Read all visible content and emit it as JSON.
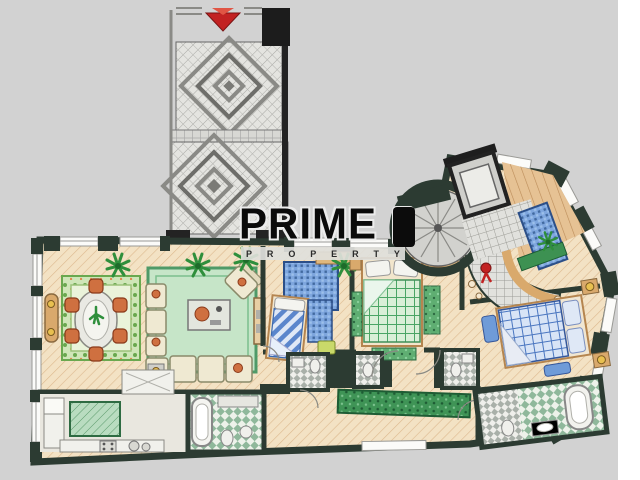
{
  "watermark": {
    "title": "PRIME",
    "subtitle": "PROPERTY",
    "subtitle_letters": [
      "P",
      "R",
      "O",
      "P",
      "E",
      "R",
      "T",
      "Y"
    ]
  },
  "palette": {
    "background": "#d2d2d2",
    "paper_margin": "#ffffff",
    "wall_dark": "#2c3b32",
    "vestibule_wall": "#232323",
    "floor_wood": "#f3e2c4",
    "tile_gray": "#e1e1dd",
    "rug_green": "#c6e5c8",
    "rug_blue": "#6f9bd8",
    "bed_green_plaid": "#4aa565",
    "bed_blue_plaid": "#4a76c0",
    "wood_trim": "#d9a96c",
    "chair_terracotta": "#cf7040",
    "plant_green": "#2f8f3c",
    "entry_marker_red": "#c22222",
    "watermark_ink": "#0a0a0a"
  }
}
